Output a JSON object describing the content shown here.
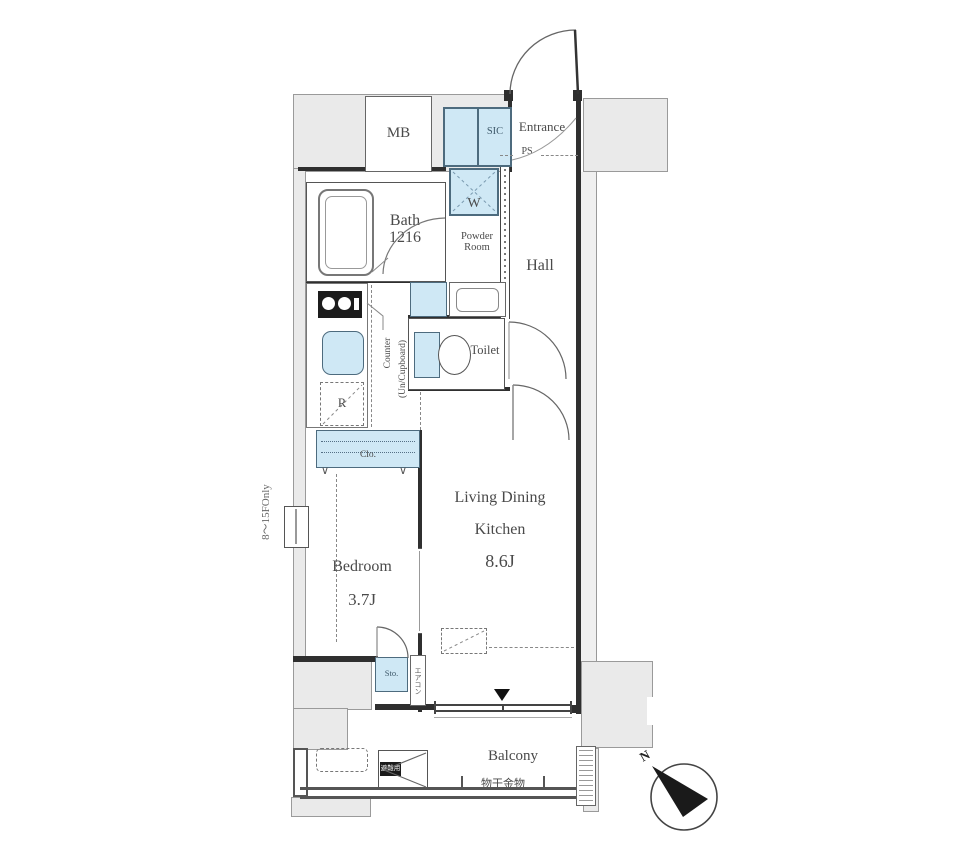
{
  "plan": {
    "title": "apartment-floor-plan",
    "labels": {
      "mb": "MB",
      "sic": "SIC",
      "entrance": "Entrance",
      "ps": "PS",
      "bath_l1": "Bath",
      "bath_l2": "1216",
      "washer": "W",
      "powder_l1": "Powder",
      "powder_l2": "Room",
      "hall": "Hall",
      "toilet": "Toilet",
      "counter_l1": "Counter",
      "counter_l2": "(Un/Cupboard)",
      "fridge": "R",
      "closet": "Clo.",
      "bedroom": "Bedroom",
      "bedroom_size": "3.7J",
      "ldk_l1": "Living Dining",
      "ldk_l2": "Kitchen",
      "ldk_size": "8.6J",
      "storage": "Sto.",
      "aircon": "エアコン",
      "floors_note": "8〜15FOnly",
      "balcony": "Balcony",
      "laundry_hardware": "物干金物",
      "evacuation_hatch": "避難用",
      "north": "N"
    },
    "colors": {
      "fixture_blue": "#cfe8f5",
      "common_area_gray": "#eaeaea",
      "wall": "#2f2f2f",
      "text": "#4a4a4a"
    }
  }
}
